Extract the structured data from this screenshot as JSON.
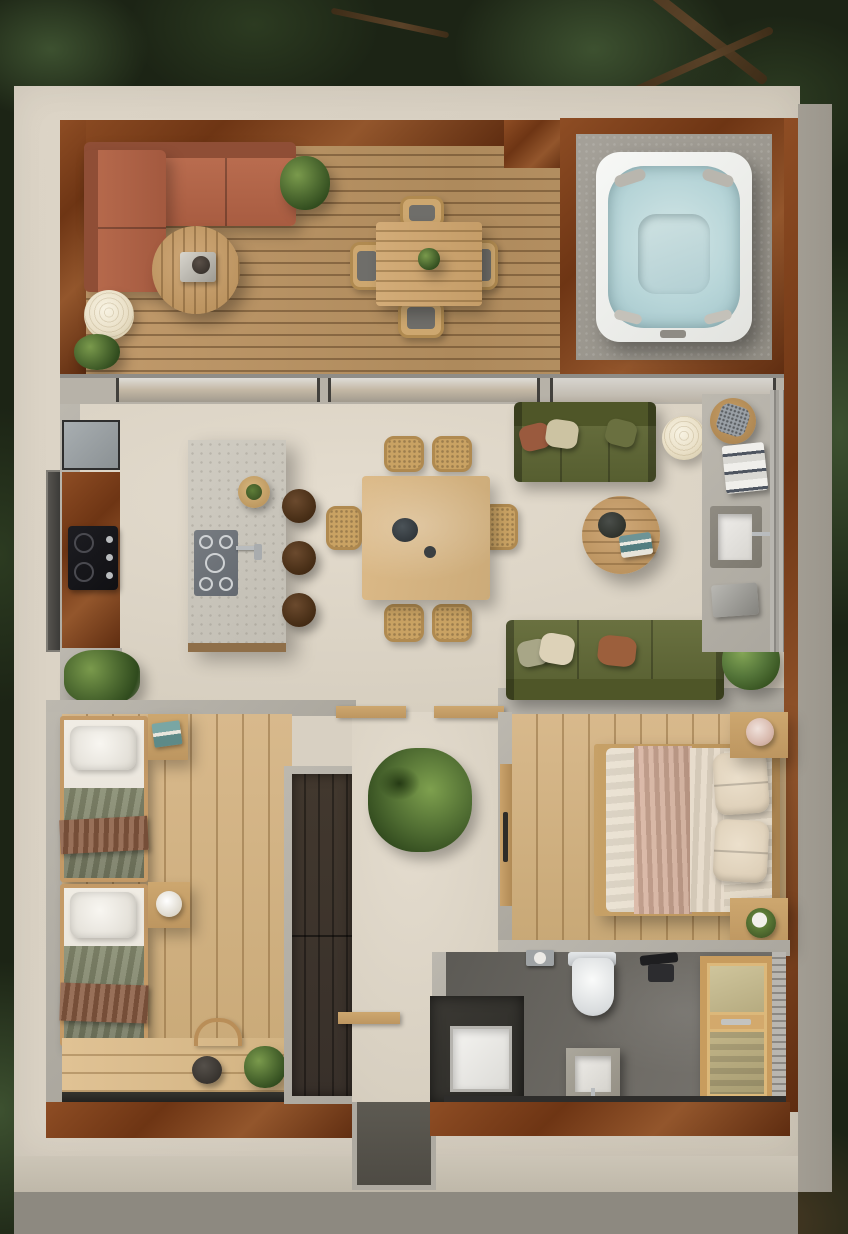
{
  "scene": {
    "type": "floor-plan-render",
    "view": "top-down aerial",
    "description": "Photorealistic top-down 3D floor plan of a small modern cabin on a beige concrete plinth, surrounded by dark evergreen forest",
    "style": "modern cabin with corten steel, concrete and light wood"
  },
  "palette": {
    "foliage-dark": "#1c2415",
    "foliage-mid": "#2c3b21",
    "foliage-light": "#3d5130",
    "branch": "#5a4228",
    "slab": "#d8d0c2",
    "slab-side": "#9b968c",
    "slab-face": "#ccc5b7",
    "ground": "#8d8980",
    "corten": "#8a4a22",
    "corten-dk": "#5f3014",
    "deck-wood": "#b8905f",
    "pine": "#d3b285",
    "beige": "#ddd5c8",
    "concrete": "#b5b1a8",
    "concrete-dk": "#8f8c84",
    "terracotta": "#b4674a",
    "terracotta-dk": "#8f4e36",
    "olive": "#5d6234",
    "olive-dk": "#494e28",
    "walnut": "#4a3a2a",
    "wardrobe": "#38302a",
    "stone": "#cbc7bd",
    "steel": "#9aa0a3",
    "cooktop": "#17171b",
    "water": "#b9d7d9",
    "tub": "#f2f3f1",
    "bathfloor": "#6b6862",
    "bathdark": "#35332e",
    "white": "#f4f2ee",
    "cream": "#e8dfcf",
    "blush": "#d2ab97",
    "blanket": "#7d8266",
    "throw": "#8a5e43",
    "teal": "#5f8a8c",
    "plant": "#4e6b33",
    "lamp": "#efe7d2",
    "woodmid": "#c59f6b"
  },
  "rooms": {
    "deck": {
      "label": "Outdoor deck terrace",
      "items": [
        "terracotta L-shaped sectional sofa",
        "round wooden coffee table with tray",
        "paper lantern floor lamp",
        "two potted plants",
        "square timber dining table with centerpiece plant",
        "four timber chairs with grey seat pads",
        "corten steel planter edge"
      ]
    },
    "hot_tub": {
      "label": "Hot tub corner",
      "items": [
        "white square hot tub with pale aqua water",
        "four grey headrests",
        "center seat well",
        "control panel",
        "concrete pad",
        "corten steel surround"
      ]
    },
    "kitchen": {
      "label": "Kitchen",
      "items": [
        "corten steel wall counter",
        "black built-in cooktop with control knobs",
        "steel fridge panel",
        "side window slot",
        "stone kitchen island with wood base",
        "grey induction hob with five burners",
        "island faucet",
        "wooden bowl with herbs",
        "three walnut bar stools",
        "potted plant"
      ]
    },
    "dining_area": {
      "label": "Dining area",
      "items": [
        "light oak rectangular dining table",
        "six rattan chairs",
        "dark teal teapot",
        "small cup"
      ]
    },
    "living_room": {
      "label": "Living room",
      "items": [
        "olive two-seat sofa with rust, sage and olive cushions",
        "paper lantern floor lamp",
        "round oak coffee table with black pot and teal books",
        "olive three-seat sofa with sage, cream and rust cushions",
        "fern plant on concrete ledge"
      ]
    },
    "vanity_nook": {
      "label": "Side vanity nook",
      "items": [
        "concrete counter",
        "round stool with patterned cushion",
        "stack of striped towels",
        "recessed white basin with wall faucet",
        "metal tray",
        "sliding glass door track"
      ]
    },
    "hallway": {
      "label": "Hallway",
      "items": [
        "large potted indoor plant",
        "timber door lintels",
        "entry step"
      ]
    },
    "kids_bedroom": {
      "label": "Twin bedroom",
      "items": [
        "two single beds with white pillows, green blankets and brown throws",
        "nightstand with teal books",
        "nightstand with round white lamp",
        "pale pine plank floor",
        "window desk bench with chair, dark teapot and plant",
        "tall dark-wood wardrobe"
      ]
    },
    "master_bedroom": {
      "label": "Master bedroom",
      "items": [
        "double bed with cream and blush layered bedding",
        "four cream pillows",
        "timber bed platform and headboard",
        "two timber nightstands with vase and plant bowl",
        "sliding timber door with dark handle",
        "pale pine plank floor"
      ]
    },
    "bathroom": {
      "label": "Bathroom",
      "items": [
        "white toilet",
        "toilet paper holder",
        "black towel fixture",
        "concrete pedestal basin",
        "white shower tray in dark alcove",
        "timber-framed frosted sauna door",
        "dark concrete floor",
        "corten threshold"
      ]
    },
    "surroundings": {
      "label": "Evergreen forest surroundings",
      "items": [
        "pine canopy",
        "bare branches",
        "beige concrete plinth",
        "shadowed ground step"
      ]
    }
  }
}
